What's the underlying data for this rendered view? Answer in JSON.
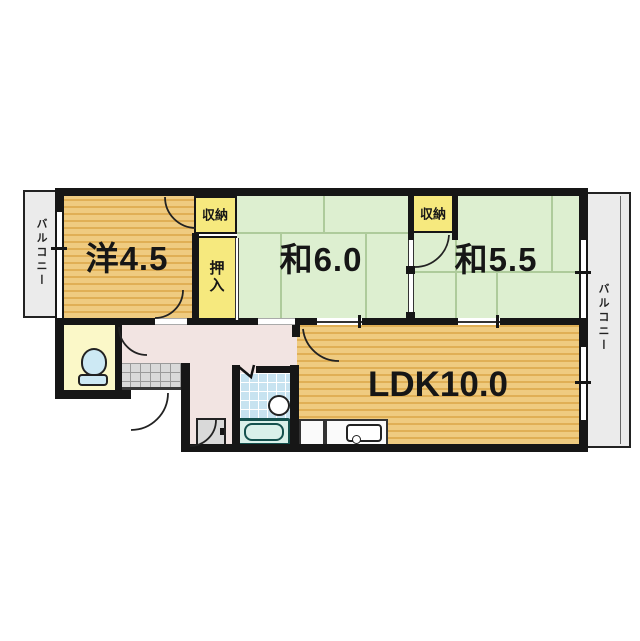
{
  "plan": {
    "type": "apartment-floor-plan",
    "rooms": {
      "western": {
        "label": "洋4.5"
      },
      "tatami6": {
        "label": "和6.0"
      },
      "tatami55": {
        "label": "和5.5"
      },
      "ldk": {
        "label": "LDK10.0"
      }
    },
    "storage": {
      "closet_left": {
        "label": "収納"
      },
      "closet_right": {
        "label": "収納"
      },
      "oshiire": {
        "label": "押入"
      }
    },
    "balconies": {
      "left": {
        "label": "バルコニー"
      },
      "right": {
        "label": "バルコニー"
      }
    },
    "fixtures": [
      "toilet-icon",
      "bathtub-icon",
      "wash-basin-icon",
      "kitchen-sink-icon",
      "washing-machine-pan",
      "entrance-tiles"
    ],
    "colors": {
      "wood_floor": "#EFCB80",
      "wood_stripe": "#E0AF55",
      "tatami": "#DDEFD0",
      "storage_fill": "#F6E97E",
      "hallway": "#F2E4E2",
      "toilet_room": "#FBF8C8",
      "bath_tile": "#C7E3F0",
      "balcony": "#EBEBEB",
      "wall": "#161616"
    }
  }
}
